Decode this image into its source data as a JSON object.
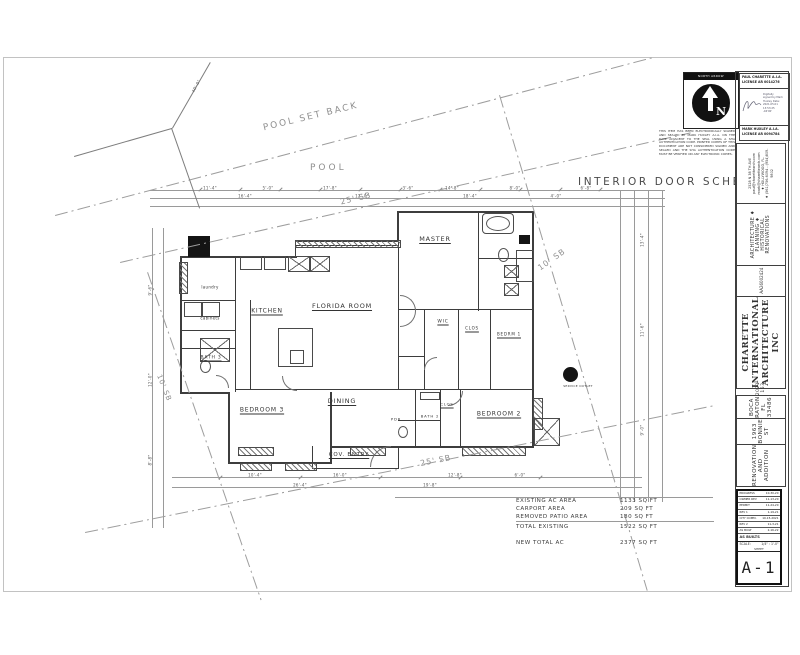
{
  "drawing": {
    "schedule_title": "INTERIOR DOOR SCHEDULE",
    "site": {
      "pool_set_back": "POOL SET BACK",
      "pool": "POOL",
      "sb_25_top": "25' SB",
      "sb_10_right": "10' SB",
      "sb_10_left": "10' SB",
      "sb_25_bottom": "25' SB"
    },
    "rooms": [
      {
        "t": "MASTER",
        "x": 435,
        "y": 239,
        "fs": 6.5,
        "u": true
      },
      {
        "t": "KITCHEN",
        "x": 267,
        "y": 311,
        "fs": 6,
        "u": true
      },
      {
        "t": "FLORIDA ROOM",
        "x": 342,
        "y": 306,
        "fs": 6.5,
        "u": true
      },
      {
        "t": "WIC",
        "x": 443,
        "y": 322,
        "fs": 4.5,
        "u": true
      },
      {
        "t": "CLOS",
        "x": 472,
        "y": 328,
        "fs": 4,
        "u": true
      },
      {
        "t": "BEDRM 1",
        "x": 509,
        "y": 334,
        "fs": 4,
        "u": true
      },
      {
        "t": "BATH 3",
        "x": 211,
        "y": 358,
        "fs": 4.5,
        "u": true
      },
      {
        "t": "BEDROOM 3",
        "x": 262,
        "y": 410,
        "fs": 6,
        "u": true
      },
      {
        "t": "DINING",
        "x": 342,
        "y": 401,
        "fs": 6.5,
        "u": true
      },
      {
        "t": "COV. ENTRY",
        "x": 349,
        "y": 455,
        "fs": 5.5,
        "u": true
      },
      {
        "t": "PDR",
        "x": 396,
        "y": 419,
        "fs": 3.8,
        "u": false
      },
      {
        "t": "BATH 2",
        "x": 430,
        "y": 416,
        "fs": 3.8,
        "u": false
      },
      {
        "t": "CLOS",
        "x": 447,
        "y": 404,
        "fs": 3.8,
        "u": true
      },
      {
        "t": "BEDROOM 2",
        "x": 499,
        "y": 414,
        "fs": 6,
        "u": true
      }
    ],
    "annotations": [
      {
        "t": "laundry",
        "x": 210,
        "y": 287,
        "fs": 4
      },
      {
        "t": "cabinets",
        "x": 210,
        "y": 318,
        "fs": 4
      },
      {
        "t": "SERVICE OUTLET",
        "x": 578,
        "y": 386,
        "fs": 3
      }
    ],
    "dims": [
      {
        "t": "11'-4\"",
        "x": 210,
        "y": 188
      },
      {
        "t": "5'-0\"",
        "x": 268,
        "y": 188
      },
      {
        "t": "17'-8\"",
        "x": 330,
        "y": 188
      },
      {
        "t": "3'-6\"",
        "x": 408,
        "y": 188
      },
      {
        "t": "14'-8\"",
        "x": 452,
        "y": 188
      },
      {
        "t": "8'-0\"",
        "x": 515,
        "y": 188
      },
      {
        "t": "6'-8\"",
        "x": 586,
        "y": 188
      },
      {
        "t": "16'-4\"",
        "x": 245,
        "y": 196
      },
      {
        "t": "12'-0\"",
        "x": 362,
        "y": 196
      },
      {
        "t": "18'-4\"",
        "x": 470,
        "y": 196
      },
      {
        "t": "4'-0\"",
        "x": 556,
        "y": 196
      },
      {
        "t": "10'-4\"",
        "x": 255,
        "y": 475
      },
      {
        "t": "16'-0\"",
        "x": 340,
        "y": 475
      },
      {
        "t": "12'-8\"",
        "x": 455,
        "y": 475
      },
      {
        "t": "6'-0\"",
        "x": 520,
        "y": 475
      },
      {
        "t": "26'-4\"",
        "x": 300,
        "y": 485
      },
      {
        "t": "19'-8\"",
        "x": 430,
        "y": 485
      },
      {
        "t": "9'-6\"",
        "x": 150,
        "y": 290,
        "rot": -90
      },
      {
        "t": "12'-0\"",
        "x": 150,
        "y": 380,
        "rot": -90
      },
      {
        "t": "8'-8\"",
        "x": 150,
        "y": 460,
        "rot": -90
      },
      {
        "t": "13'-4\"",
        "x": 642,
        "y": 240,
        "rot": -90
      },
      {
        "t": "11'-6\"",
        "x": 642,
        "y": 330,
        "rot": -90
      },
      {
        "t": "9'-0\"",
        "x": 642,
        "y": 430,
        "rot": -90
      },
      {
        "t": "40'-0\"",
        "x": 196,
        "y": 86,
        "rot": -62
      }
    ],
    "areas": {
      "rows": [
        {
          "label": "EXISTING AC AREA",
          "value": "1133 SQ FT"
        },
        {
          "label": "CARPORT AREA",
          "value": "209 SQ FT"
        },
        {
          "label": "REMOVED PATIO AREA",
          "value": "180 SQ FT"
        }
      ],
      "total": {
        "label": "TOTAL EXISTING",
        "value": "1522 SQ FT"
      },
      "new_total": {
        "label": "NEW TOTAL AC",
        "value": "2377 SQ FT"
      }
    }
  },
  "stamps": {
    "north_arrow_label": "NORTH ARROW",
    "north_letter": "N",
    "paul_line1": "PAUL CHARETTE A.I.A.",
    "paul_line2": "LICENSE   AR 0014276",
    "signature_note": "Digitally signed by Mark Huxley  Date: 2021.05.01 13:53:25 -04'00'",
    "mark_line1": "MARK HUXLEY A.I.A.",
    "mark_line2": "LICENSE   AR 0094784",
    "disclaimer": "THIS ITEM HAS BEEN ELECTRONICALLY SIGNED AND SEALED BY MARK HUXLEY A.I.A. ON THE DATE ADJACENT TO THE SEAL USING A SHA AUTHENTICATION CODE. PRINTED COPIES OF THIS DOCUMENT ARE NOT CONSIDERED SIGNED AND SEALED AND THE SHA AUTHENTICATION CODE MUST BE VERIFIED ON ANY ELECTRONIC COPIES."
  },
  "titleblock": {
    "company": {
      "name": "CHARETTE INTERNATIONAL ARCHITECTURE INC",
      "license_no": "AA26002424",
      "services": "ARCHITECTURE ♦ PLANNING ♦ HISTORICAL RENOVATIONS",
      "address": "2528 N 38 TH AVE",
      "email1": "paul@charettearch.com",
      "email2": "mark@charettearch.com",
      "city": "♦ HOLLYWOOD, FL.",
      "phone": "♦ (561)756-6094 - (954)809-9802"
    },
    "project": {
      "title": "RENOVATION AND ADDITION",
      "address": "1963 BONNIE ST",
      "city": "BOCA RATON FL 33486",
      "job_no": "2021-153"
    },
    "revisions": [
      {
        "label": "PROGRESS",
        "date": "10-30-20"
      },
      {
        "label": "OWNER REV",
        "date": "11-13-20"
      },
      {
        "label": "PERMIT",
        "date": "11-24-20"
      },
      {
        "label": "REV 1",
        "date": "1-19-21"
      },
      {
        "label": "CITY COMM.",
        "date": "10-15-2021"
      },
      {
        "label": "REV 2",
        "date": "11-3-21"
      },
      {
        "label": "AS BUILT",
        "date": "2-16-22"
      }
    ],
    "as_builts": "AS BUILTS",
    "scale_label": "SCALE:",
    "scale_value": "1/4\" : 1'-0\"",
    "sheet_label": "SHEET",
    "sheet_no": "A-1"
  }
}
